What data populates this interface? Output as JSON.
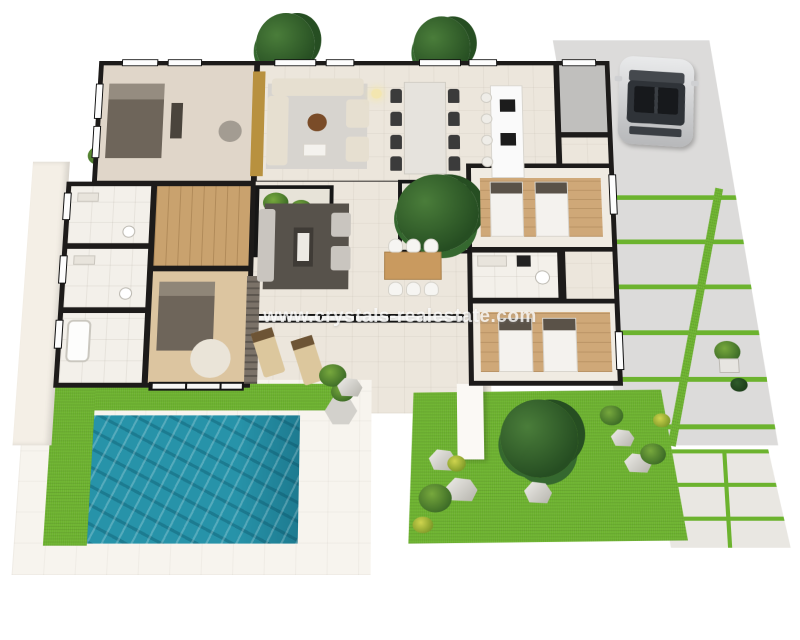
{
  "watermark": {
    "text": "www.crystals-realestate.com"
  },
  "scene": {
    "type": "3d-isometric-floor-plan",
    "features": [
      "master-bedroom",
      "living-room",
      "dining-area",
      "kitchen-island",
      "twin-bedroom-1",
      "twin-bedroom-2",
      "bathroom-1",
      "bathroom-2",
      "bathroom-3",
      "interior-courtyard-1",
      "interior-courtyard-2",
      "hallway",
      "utility-room",
      "terrace-lounge",
      "outdoor-dining",
      "sun-loungers",
      "swimming-pool",
      "lawn-garden",
      "driveway",
      "parked-car",
      "trees",
      "rocks",
      "planters"
    ]
  },
  "palette": {
    "wall": "#1d1b1a",
    "floor_cream": "#ece6dc",
    "floor_tile": "#f3f0ea",
    "wood": "#c9a26e",
    "wood_light": "#cfa878",
    "pool_water": "#2793a9",
    "pool_water_dark": "#1e7c92",
    "grass": "#6cb32e",
    "grass_dark": "#559122",
    "driveway": "#dcdbda",
    "paving": "#e9e7e2",
    "car_body": "#d0d1d3",
    "accent_gold": "#b8913f",
    "furniture_dark": "#6e655a",
    "sofa_beige": "#e6dfd0",
    "rug_gray": "#57524b",
    "tree_light": "#4a7d3a",
    "tree_mid": "#35682f",
    "tree_dark": "#264e22"
  }
}
